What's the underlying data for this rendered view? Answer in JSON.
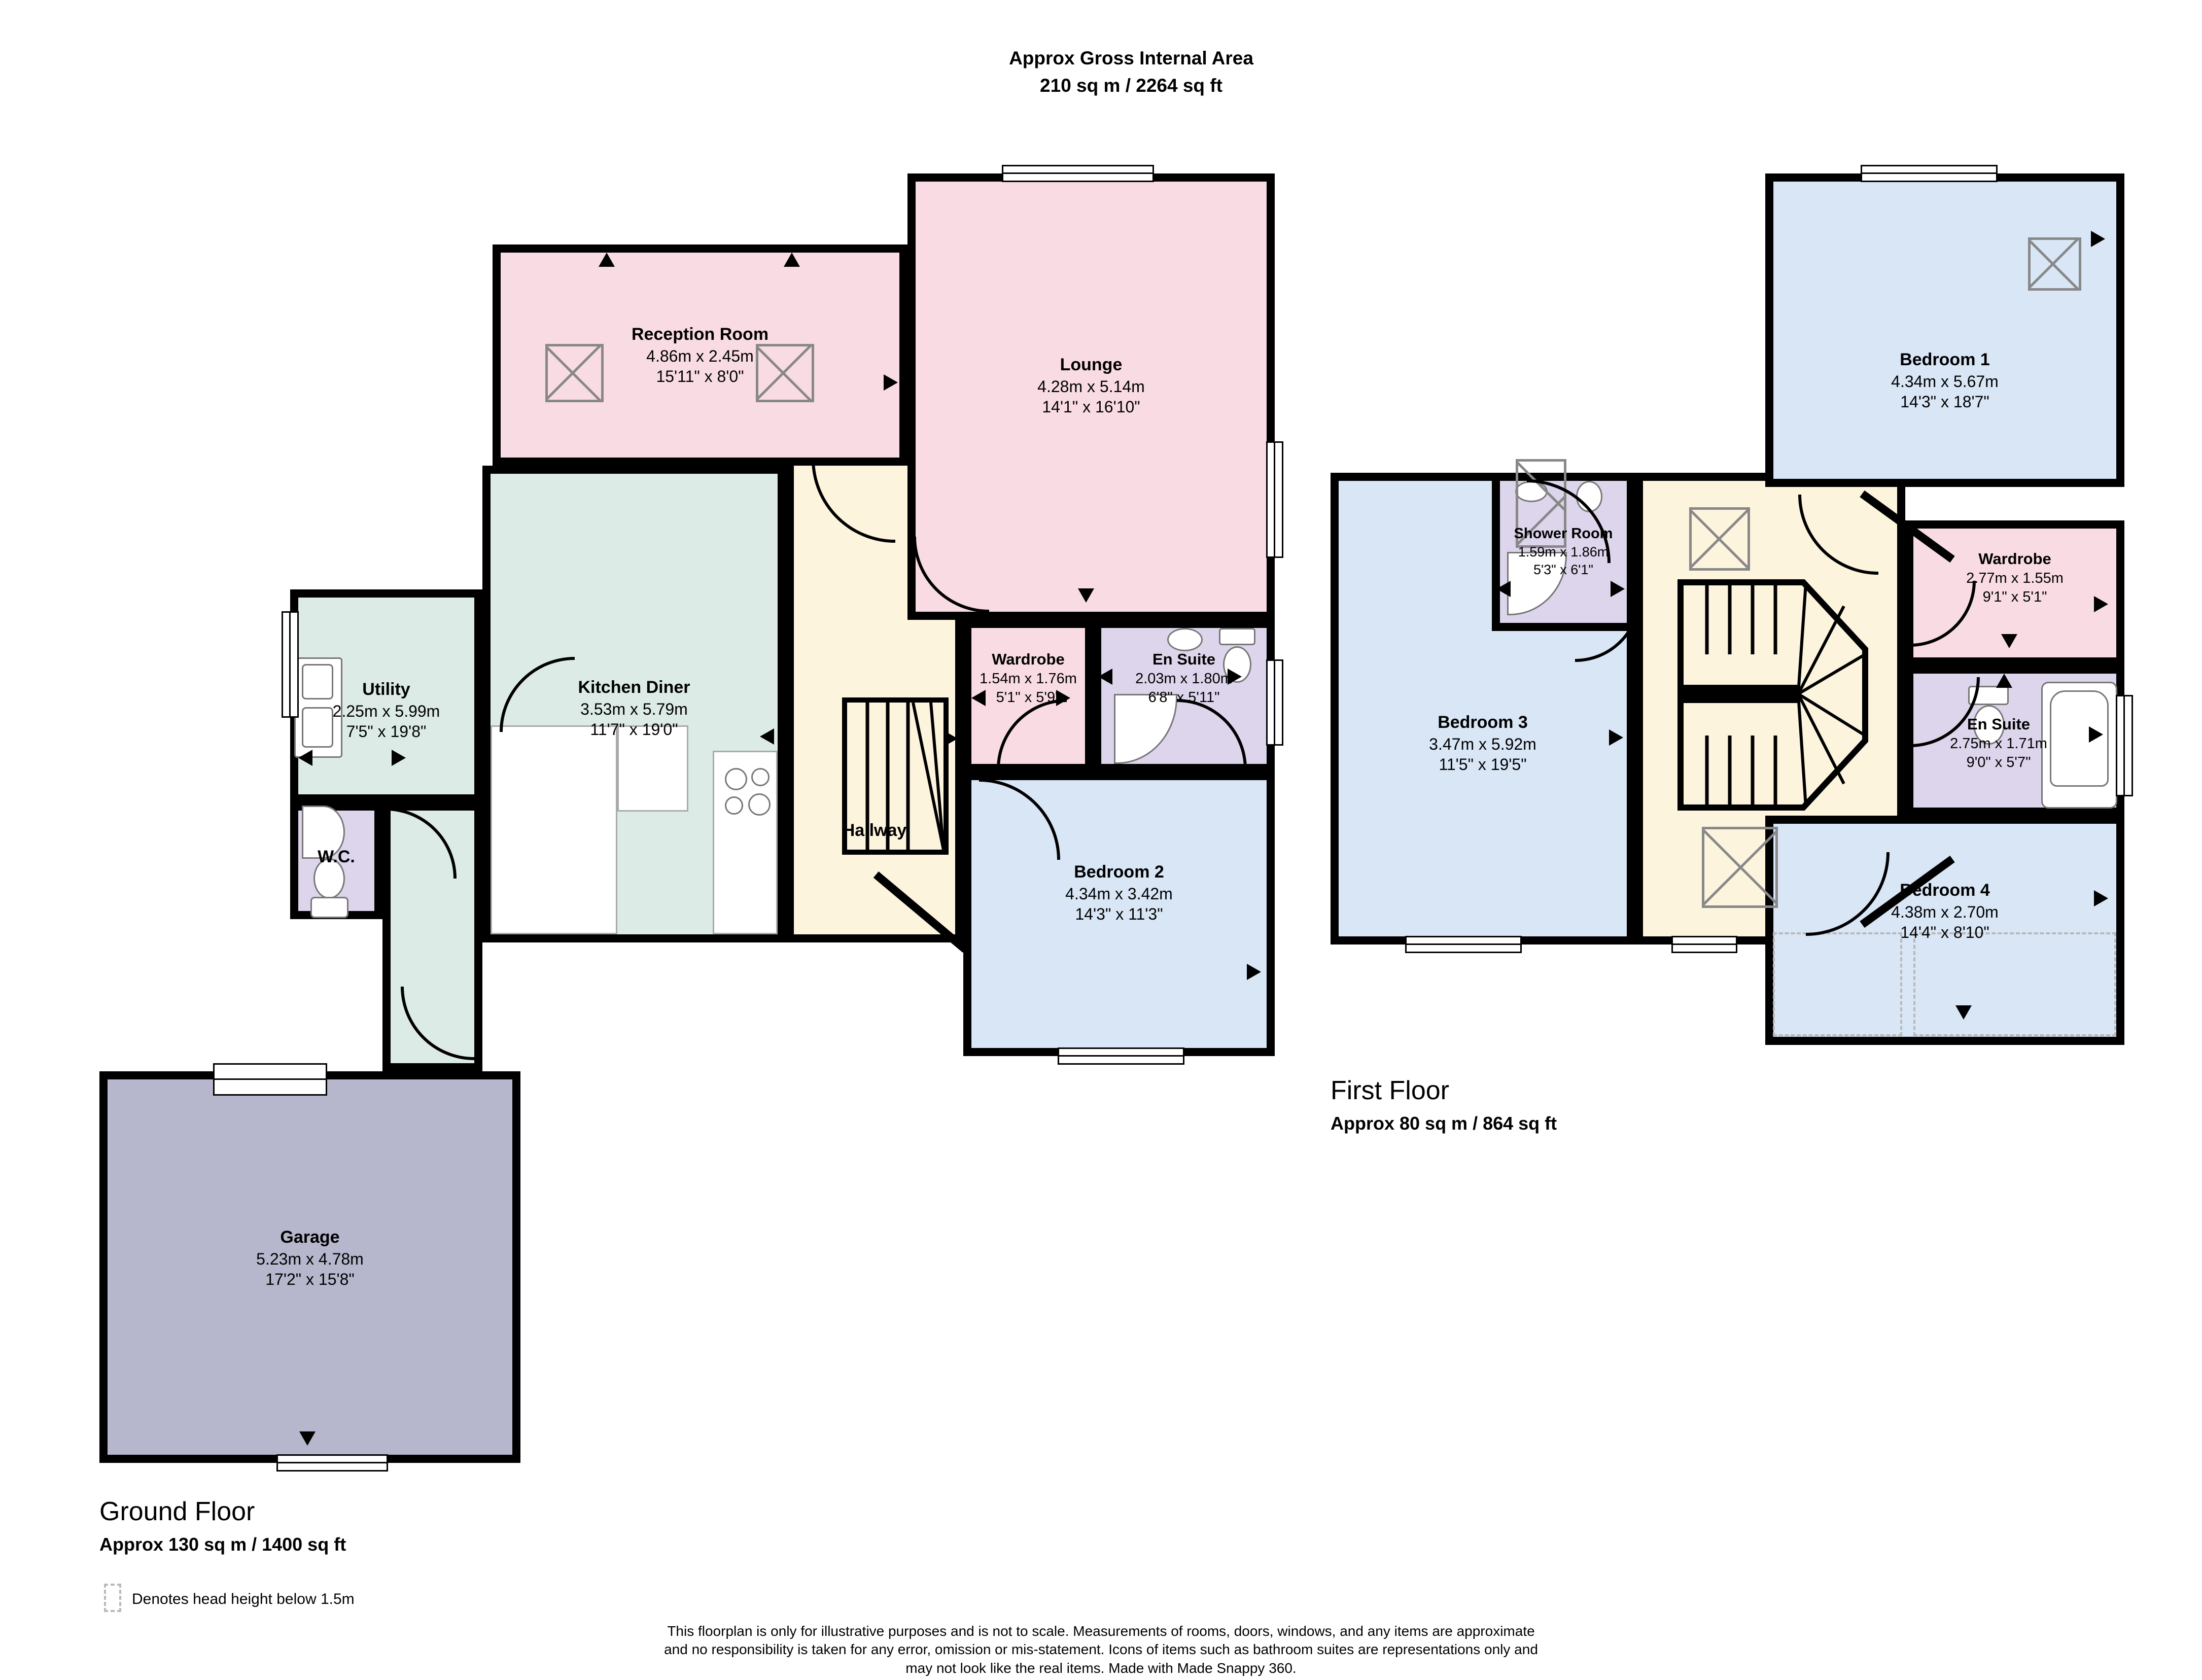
{
  "title": {
    "line1": "Approx Gross Internal Area",
    "line2": "210 sq m / 2264 sq ft"
  },
  "ground_floor": {
    "label": "Ground Floor",
    "area": "Approx 130 sq m / 1400 sq ft",
    "rooms": {
      "reception": {
        "name": "Reception Room",
        "metric": "4.86m x 2.45m",
        "imperial": "15'11\" x 8'0\""
      },
      "lounge": {
        "name": "Lounge",
        "metric": "4.28m x 5.14m",
        "imperial": "14'1\" x 16'10\""
      },
      "kitchen": {
        "name": "Kitchen Diner",
        "metric": "3.53m x 5.79m",
        "imperial": "11'7\" x 19'0\""
      },
      "utility": {
        "name": "Utility",
        "metric": "2.25m x 5.99m",
        "imperial": "7'5\" x 19'8\""
      },
      "wc": {
        "name": "W.C."
      },
      "hallway": {
        "name": "Hallway"
      },
      "wardrobe": {
        "name": "Wardrobe",
        "metric": "1.54m x 1.76m",
        "imperial": "5'1\" x 5'9\""
      },
      "ensuite": {
        "name": "En Suite",
        "metric": "2.03m x 1.80m",
        "imperial": "6'8\" x 5'11\""
      },
      "bedroom2": {
        "name": "Bedroom 2",
        "metric": "4.34m x 3.42m",
        "imperial": "14'3\" x 11'3\""
      },
      "garage": {
        "name": "Garage",
        "metric": "5.23m x 4.78m",
        "imperial": "17'2\" x 15'8\""
      }
    }
  },
  "first_floor": {
    "label": "First Floor",
    "area": "Approx 80 sq m / 864 sq ft",
    "rooms": {
      "bedroom1": {
        "name": "Bedroom 1",
        "metric": "4.34m x 5.67m",
        "imperial": "14'3\" x 18'7\""
      },
      "shower": {
        "name": "Shower Room",
        "metric": "1.59m x 1.86m",
        "imperial": "5'3\" x 6'1\""
      },
      "bedroom3": {
        "name": "Bedroom 3",
        "metric": "3.47m x 5.92m",
        "imperial": "11'5\" x 19'5\""
      },
      "wardrobe": {
        "name": "Wardrobe",
        "metric": "2.77m x 1.55m",
        "imperial": "9'1\" x 5'1\""
      },
      "ensuite": {
        "name": "En Suite",
        "metric": "2.75m x 1.71m",
        "imperial": "9'0\" x 5'7\""
      },
      "bedroom4": {
        "name": "Bedroom 4",
        "metric": "4.38m x 2.70m",
        "imperial": "14'4\" x 8'10\""
      }
    }
  },
  "legend": {
    "head_height": "Denotes head height below 1.5m"
  },
  "footer": {
    "line1": "This floorplan is only for illustrative purposes and is not to scale. Measurements of rooms, doors, windows, and any items are approximate",
    "line2": "and no responsibility is taken for any error, omission or mis-statement. Icons of items such as bathroom suites are representations only and",
    "line3": "may not look like the real items. Made with Made Snappy 360."
  },
  "colors": {
    "room_pink": "#f9dce3",
    "room_blue": "#d8e6f6",
    "room_green": "#dcebe5",
    "room_cream": "#fcf4dd",
    "room_purple": "#ddd5ec",
    "room_garage": "#b6b6cc",
    "wall": "#000000",
    "rooflight": "#888888"
  }
}
